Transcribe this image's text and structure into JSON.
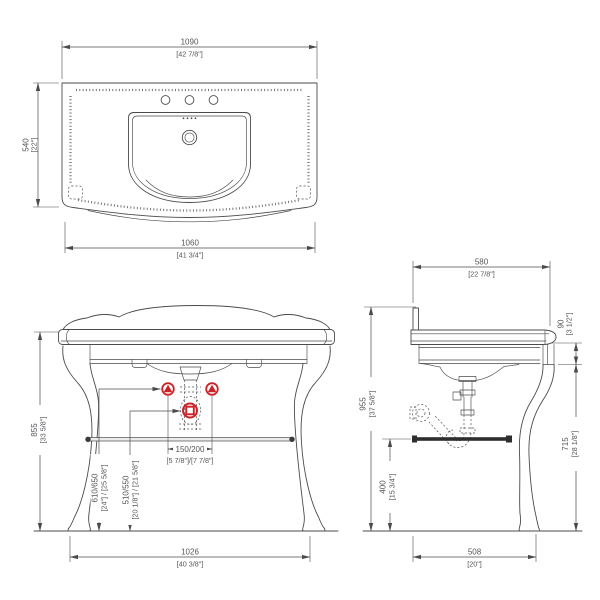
{
  "drawing_title": "console-vanity-technical-drawing",
  "colors": {
    "line": "#4a4b4d",
    "text": "#55565a",
    "accent_red": "#cc2127",
    "towel_bar": "#2e2e2e"
  },
  "top_view": {
    "overall_width": {
      "mm": "1090",
      "inch": "[42 7/8\"]"
    },
    "overall_depth": {
      "mm": "540",
      "inch": "[22\"]"
    },
    "lower_width": {
      "mm": "1060",
      "inch": "[41 3/4\"]"
    }
  },
  "front_view": {
    "console_height": {
      "mm": "855",
      "inch": "[33 5/8\"]"
    },
    "supply_spacing": {
      "mm": "150/200",
      "inch": "[5 7/8\"]/[7 7/8\"]"
    },
    "supply_height": {
      "mm": "610/650",
      "inch": "[24\"] / [25 5/8\"]"
    },
    "drain_height": {
      "mm": "510/550",
      "inch": "[20 1/8\"] / [21 5/8\"]"
    },
    "leg_span": {
      "mm": "1026",
      "inch": "[40 3/8\"]"
    }
  },
  "side_view": {
    "counter_depth": {
      "mm": "580",
      "inch": "[22 7/8\"]"
    },
    "apron_height": {
      "mm": "90",
      "inch": "[3 1/2\"]"
    },
    "total_height": {
      "mm": "955",
      "inch": "[37 5/8\"]"
    },
    "clearance_height": {
      "mm": "715",
      "inch": "[28 1/8\"]"
    },
    "towel_bar_height": {
      "mm": "400",
      "inch": "[15 3/4\"]"
    },
    "leg_span_depth": {
      "mm": "508",
      "inch": "[20\"]"
    }
  }
}
